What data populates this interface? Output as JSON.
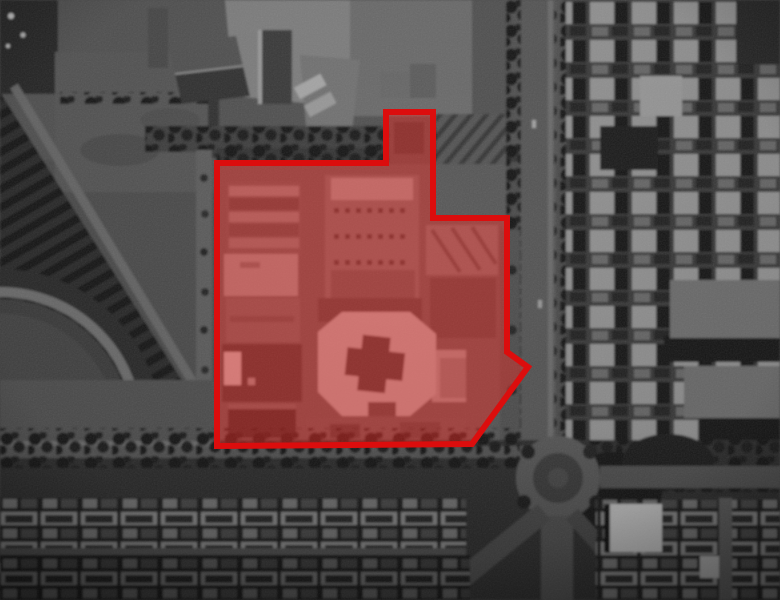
{
  "figure": {
    "type": "grayscale-satellite-image",
    "subject": "urban district with a building compound highlighted by a red polygon overlay"
  },
  "overlay": {
    "polygon_points": "217,163 386,163 386,112 433,112 433,218 507,218 507,352 528,367 472,444 217,446",
    "stroke_color": "#dc0d0d",
    "stroke_width": "6",
    "fill_color": "rgba(255,42,36,0.42)"
  }
}
